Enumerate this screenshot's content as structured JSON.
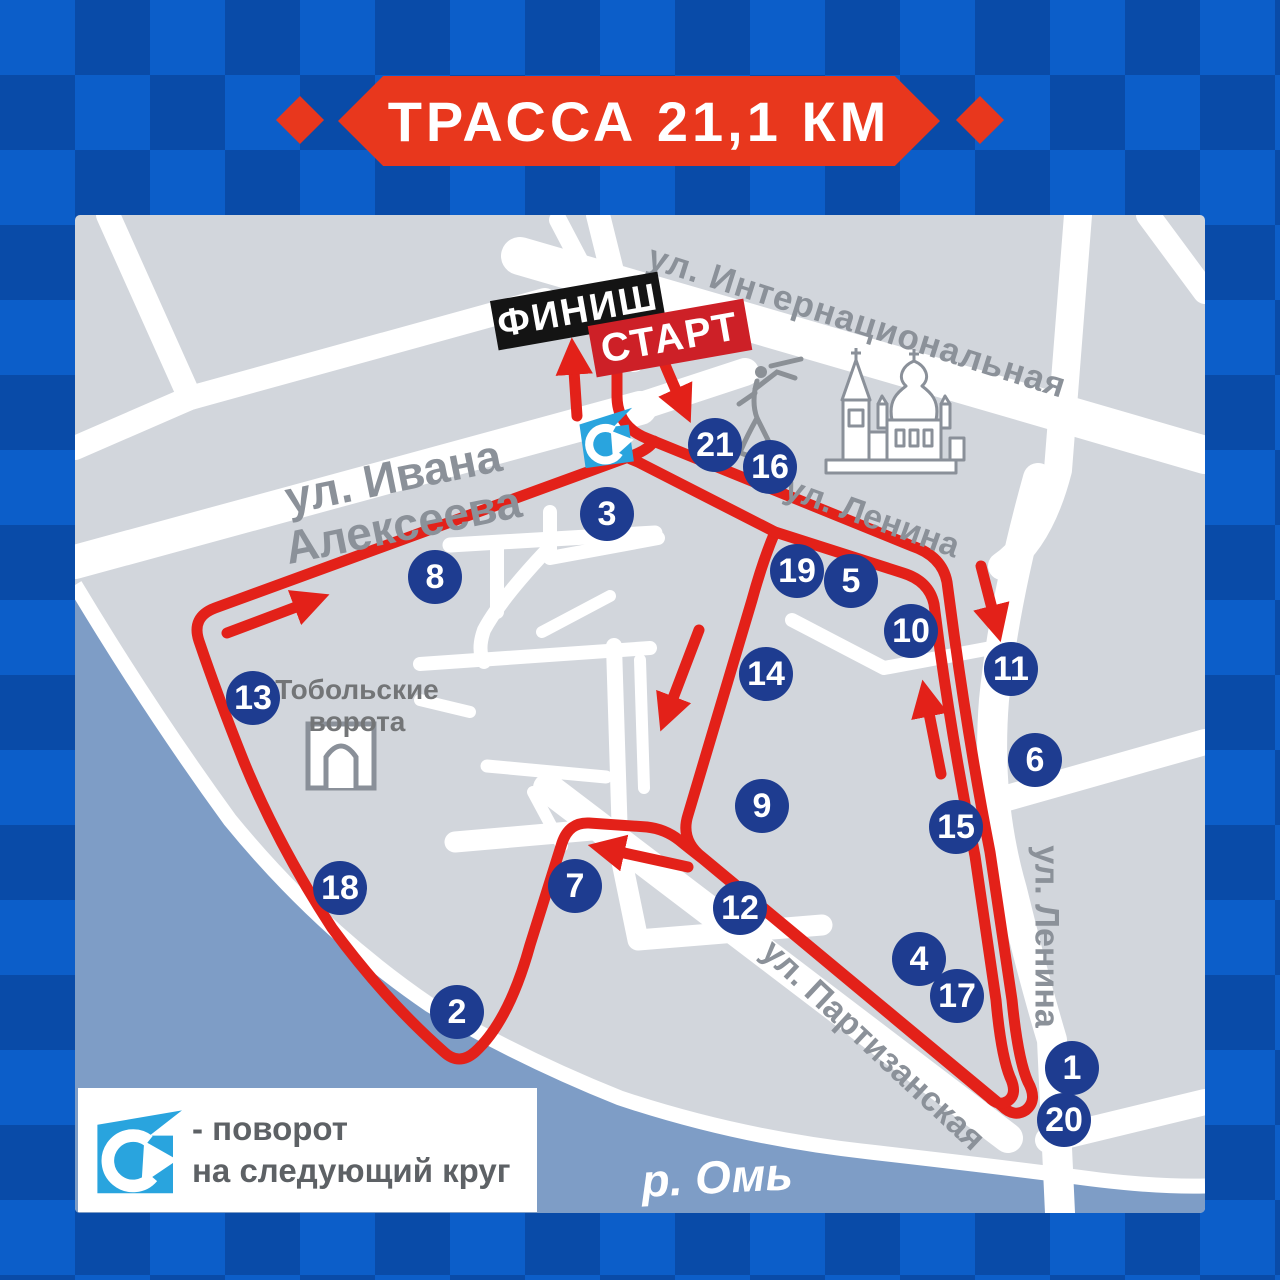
{
  "banner": {
    "title": "ТРАССА 21,1 КМ"
  },
  "map": {
    "start_label": "СТАРТ",
    "finish_label": "ФИНИШ",
    "streets": {
      "internatsionalnaya": "ул. Интернациональная",
      "ivana_alekseeva_line1": "ул. Ивана",
      "ivana_alekseeva_line2": "Алексеева",
      "lenina_diagonal": "ул. Ленина",
      "lenina_vertical": "ул. Ленина",
      "partizanskaya": "ул. Партизанская"
    },
    "landmarks": {
      "tobolsk_gates_line1": "Тобольские",
      "tobolsk_gates_line2": "ворота",
      "river": "р. Омь"
    },
    "markers": [
      {
        "n": "1",
        "x": 1072,
        "y": 1068
      },
      {
        "n": "2",
        "x": 457,
        "y": 1012
      },
      {
        "n": "3",
        "x": 607,
        "y": 514
      },
      {
        "n": "4",
        "x": 919,
        "y": 959
      },
      {
        "n": "5",
        "x": 851,
        "y": 581
      },
      {
        "n": "6",
        "x": 1035,
        "y": 760
      },
      {
        "n": "7",
        "x": 575,
        "y": 886
      },
      {
        "n": "8",
        "x": 435,
        "y": 577
      },
      {
        "n": "9",
        "x": 762,
        "y": 806
      },
      {
        "n": "10",
        "x": 911,
        "y": 631
      },
      {
        "n": "11",
        "x": 1011,
        "y": 669
      },
      {
        "n": "12",
        "x": 740,
        "y": 908
      },
      {
        "n": "13",
        "x": 253,
        "y": 698
      },
      {
        "n": "14",
        "x": 766,
        "y": 674
      },
      {
        "n": "15",
        "x": 956,
        "y": 827
      },
      {
        "n": "16",
        "x": 770,
        "y": 467
      },
      {
        "n": "17",
        "x": 957,
        "y": 996
      },
      {
        "n": "18",
        "x": 340,
        "y": 888
      },
      {
        "n": "19",
        "x": 797,
        "y": 571
      },
      {
        "n": "20",
        "x": 1064,
        "y": 1120
      },
      {
        "n": "21",
        "x": 715,
        "y": 445
      }
    ]
  },
  "legend": {
    "line1": "- поворот",
    "line2": "на следующий круг"
  },
  "colors": {
    "route_red": "#e32119",
    "banner_red": "#e8371d",
    "marker_blue": "#1e3c90",
    "turn_cyan": "#29a4de",
    "river_blue": "#7e9dc6"
  }
}
